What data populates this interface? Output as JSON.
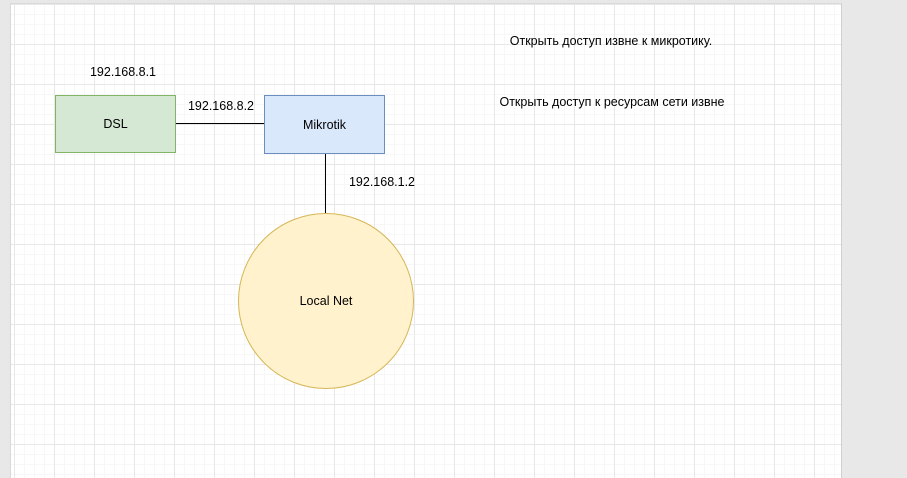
{
  "app": {
    "type": "diagram-editor-canvas"
  },
  "palette": {
    "margin_bg": "#e8e8e8",
    "page_bg": "#ffffff",
    "grid_minor": "#f7f7f7",
    "grid_major": "#e8e8e8",
    "connector": "#000000",
    "text": "#000000"
  },
  "diagram": {
    "nodes": [
      {
        "id": "dsl",
        "label": "DSL",
        "shape": "rectangle",
        "fill": "#d5e8d4",
        "stroke": "#82b366"
      },
      {
        "id": "mikrotik",
        "label": "Mikrotik",
        "shape": "rectangle",
        "fill": "#dae8fc",
        "stroke": "#6c8ebf"
      },
      {
        "id": "localnet",
        "label": "Local Net",
        "shape": "ellipse",
        "fill": "#fff2cc",
        "stroke": "#d6b656"
      }
    ],
    "edges": [
      {
        "from": "dsl",
        "to": "mikrotik",
        "orientation": "horizontal"
      },
      {
        "from": "mikrotik",
        "to": "localnet",
        "orientation": "vertical"
      }
    ],
    "labels": [
      {
        "text": "192.168.8.1",
        "attached_to": "dsl"
      },
      {
        "text": "192.168.8.2",
        "attached_to": "edge-dsl-mikrotik"
      },
      {
        "text": "192.168.1.2",
        "attached_to": "edge-mikrotik-localnet"
      }
    ],
    "notes": [
      {
        "text": "Открыть доступ извне к микротику."
      },
      {
        "text": "Открыть доступ к ресурсам сети извне"
      }
    ]
  }
}
